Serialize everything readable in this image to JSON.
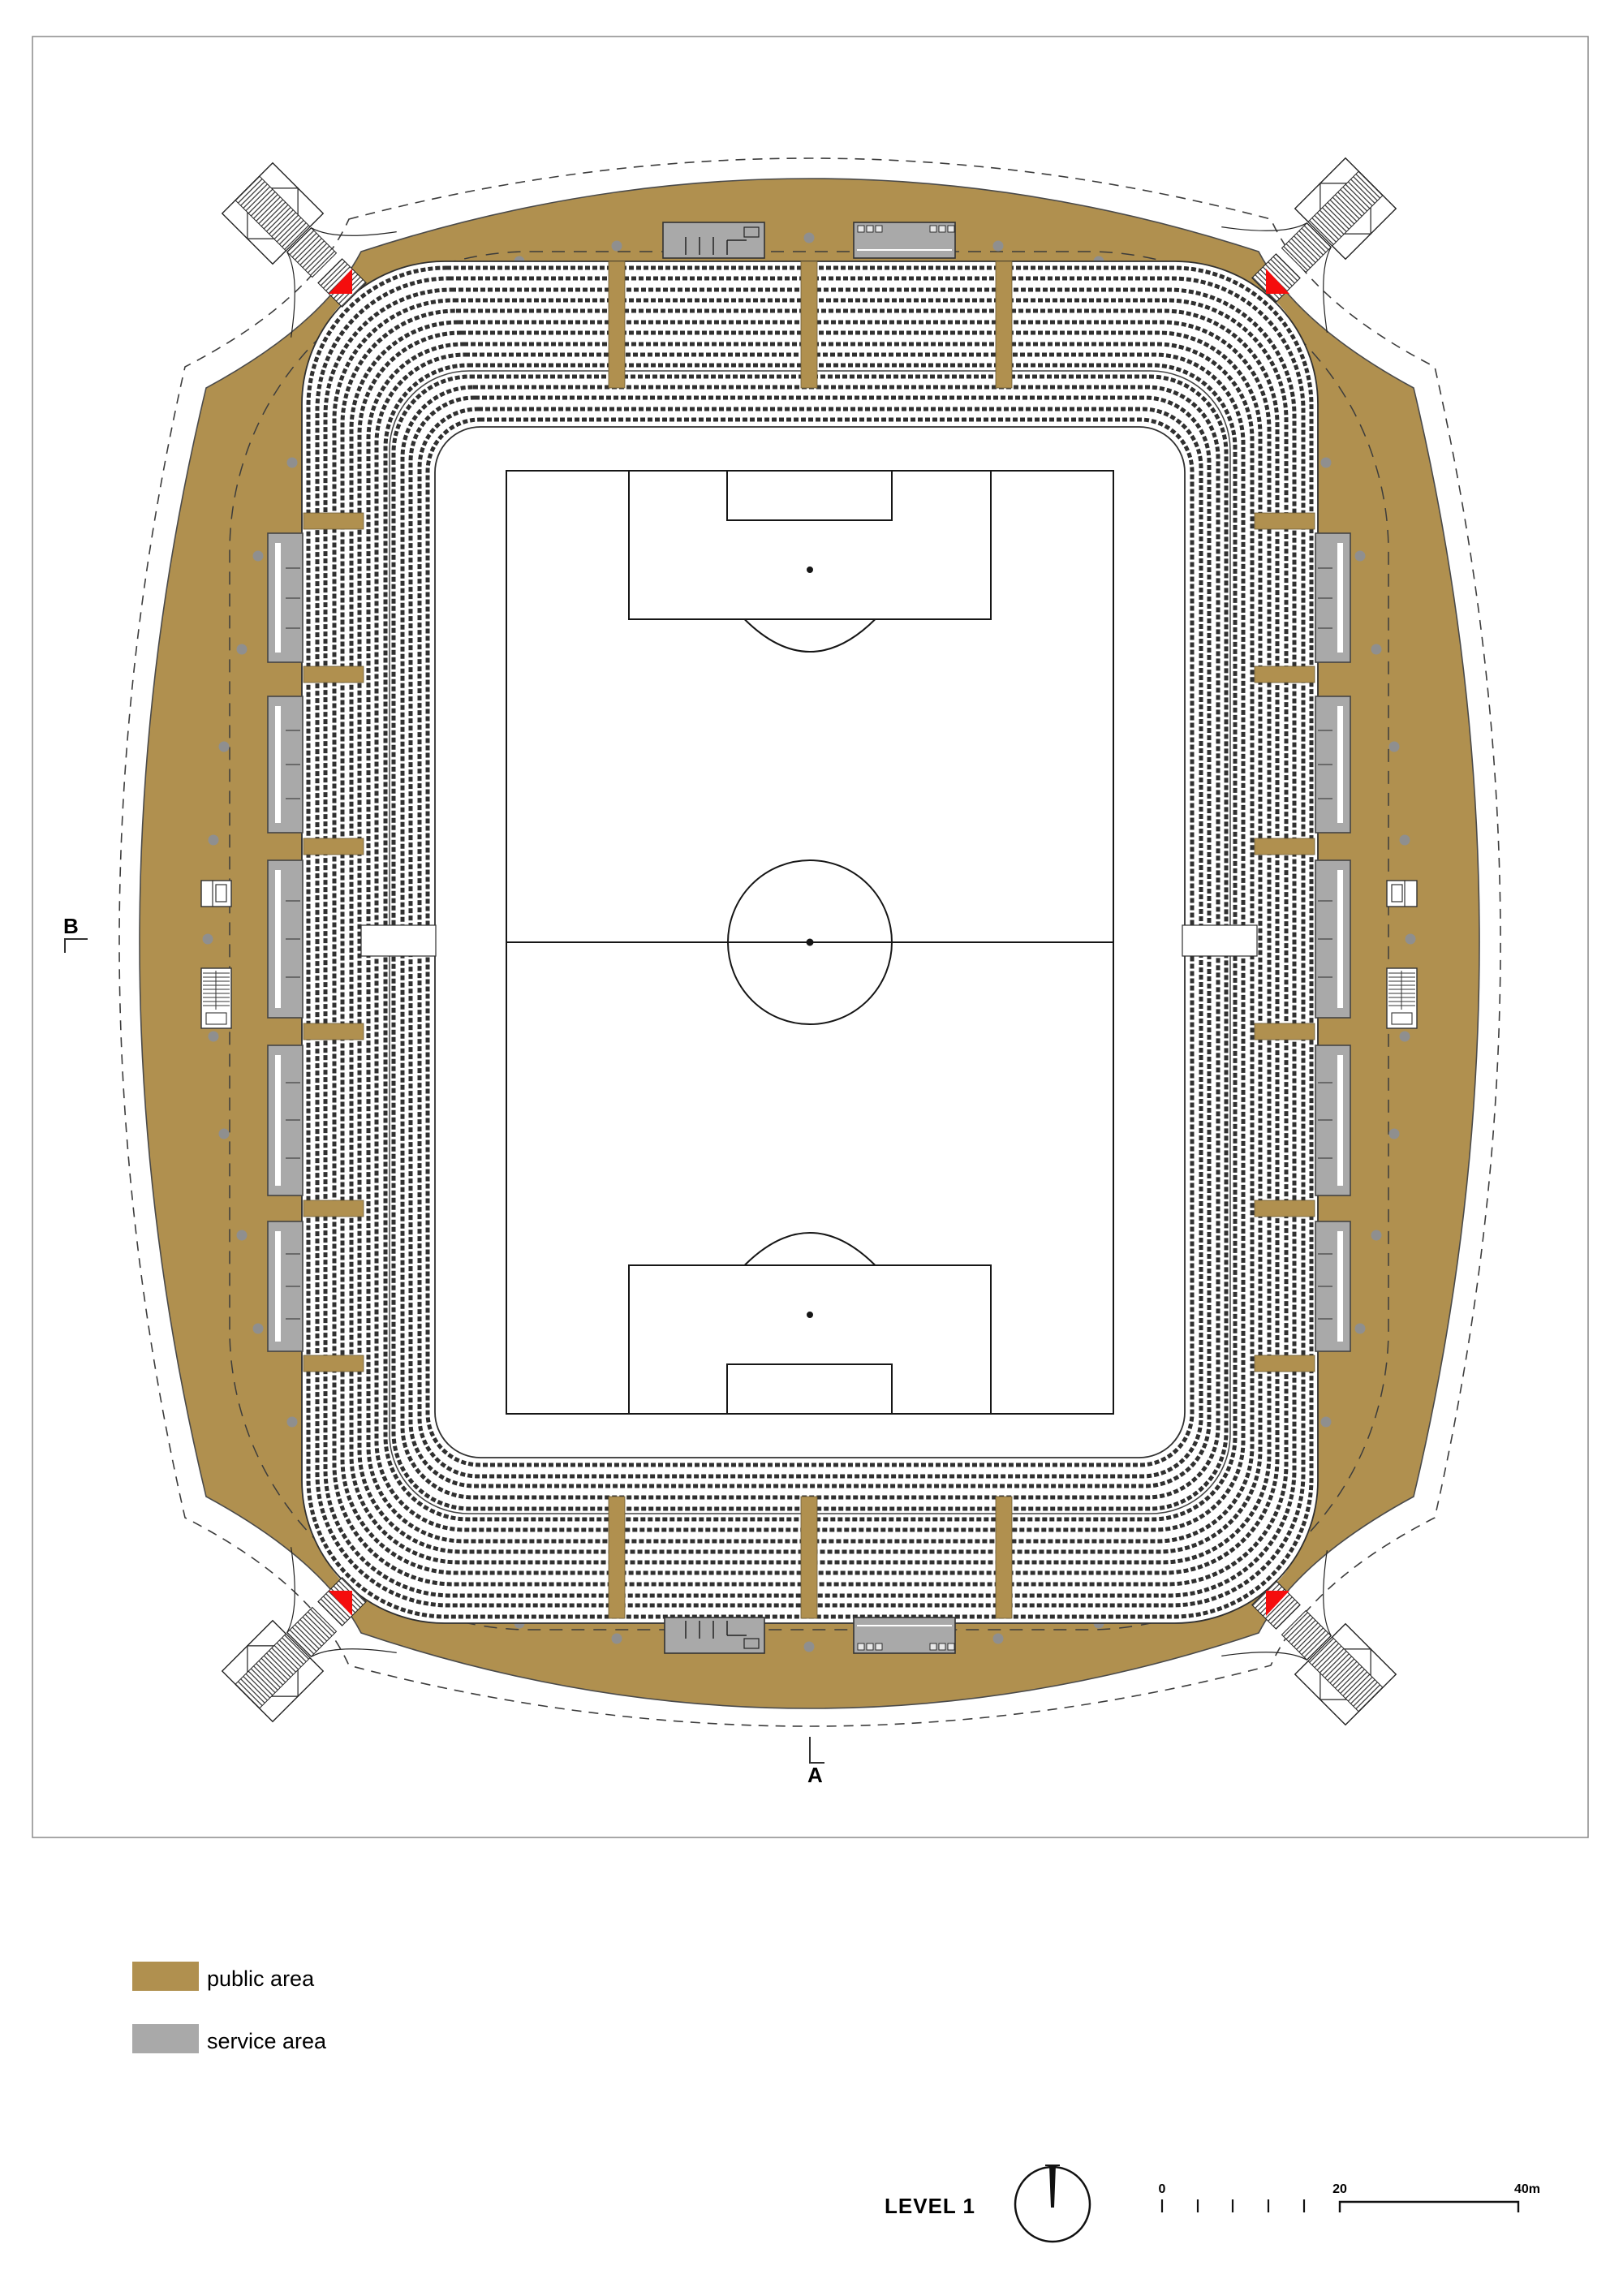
{
  "plan": {
    "level_label": "LEVEL 1",
    "drawing_type": "stadium floor plan"
  },
  "section_markers": {
    "a_label": "A",
    "b_label": "B"
  },
  "legend": {
    "items": [
      {
        "label": "public area",
        "color": "#b0904f"
      },
      {
        "label": "service area",
        "color": "#a9a9a9"
      }
    ]
  },
  "scale_bar": {
    "zero_label": "0",
    "mid_label": "20",
    "end_label": "40m"
  },
  "colors": {
    "public_area": "#b0904f",
    "service_area": "#a9a9a9",
    "marker_red": "#f50d0d",
    "seat_rows": "#303030"
  }
}
